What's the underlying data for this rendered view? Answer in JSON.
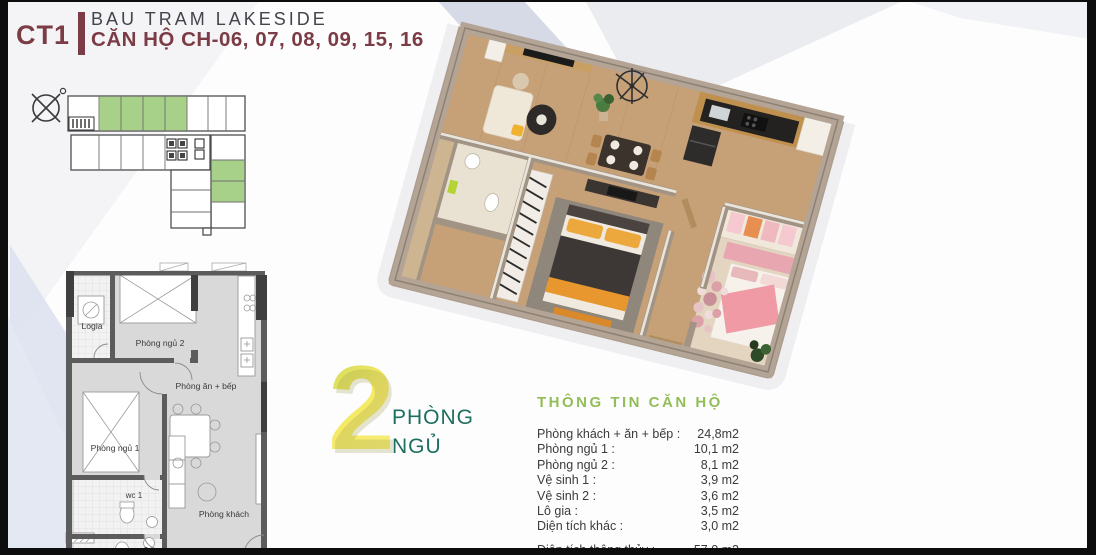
{
  "header": {
    "block": "CT1",
    "project": "BAU TRAM LAKESIDE",
    "units": "CĂN HỘ CH-06, 07, 08, 09, 15, 16"
  },
  "colors": {
    "accent_maroon": "#7b3c45",
    "title_gray": "#43444c",
    "unit_highlight_green": "#a7d089",
    "heading_green": "#93bd58",
    "badge_yellow": "#f3e964",
    "badge_teal": "#1e6e60"
  },
  "key_plan": {
    "compass_icon": "north-arrow-icon",
    "highlighted_units_top_row": 4,
    "highlighted_units_right_wing": 2
  },
  "floor_plan_2d": {
    "rooms": {
      "logia": "Logia",
      "bedroom2": "Phòng ngủ 2",
      "dining_kitchen": "Phòng ăn + bếp",
      "bedroom1": "Phòng ngủ 1",
      "wc1": "wc 1",
      "living": "Phòng khách",
      "wc2": "wc 2"
    }
  },
  "badge": {
    "number": "2",
    "line1": "PHÒNG",
    "line2": "NGỦ"
  },
  "info_panel": {
    "title": "THÔNG TIN CĂN HỘ",
    "rows": [
      {
        "label": "Phòng khách + ăn + bếp :",
        "value": "24,8m2"
      },
      {
        "label": "Phòng ngủ 1 :",
        "value": "10,1 m2"
      },
      {
        "label": "Phòng ngủ 2 :",
        "value": "8,1 m2"
      },
      {
        "label": "Vệ sinh 1 :",
        "value": "3,9 m2"
      },
      {
        "label": "Vệ sinh 2 :",
        "value": "3,6 m2"
      },
      {
        "label": "Lô gia :",
        "value": "3,5 m2"
      },
      {
        "label": "Diện tích khác :",
        "value": "3,0 m2"
      }
    ],
    "total_row": {
      "label": "Diện tích thông thủy :",
      "value": "57,0 m2"
    }
  }
}
